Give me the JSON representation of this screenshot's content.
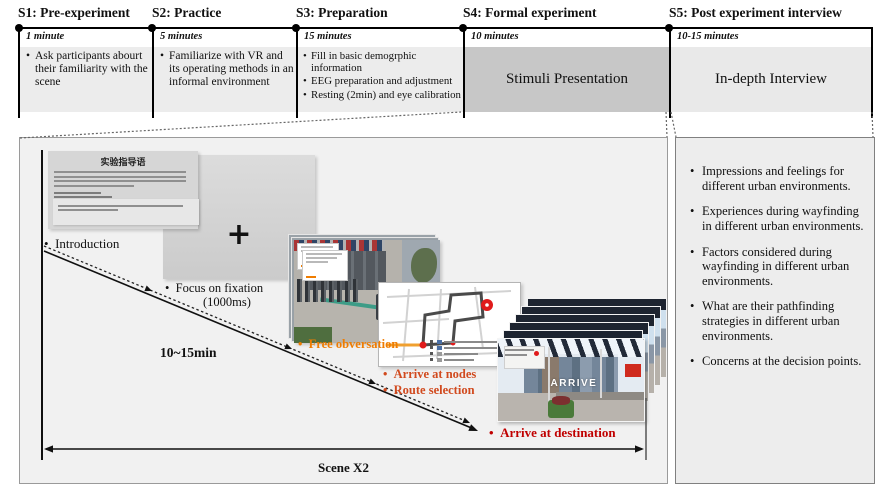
{
  "colors": {
    "s4_box_fill": "#c7c7c7",
    "free_observation_text": "#ef7c00",
    "nodes_route_text": "#d14a1e",
    "destination_text": "#c00000"
  },
  "timeline": {
    "stages": [
      {
        "title": "S1: Pre-experiment",
        "duration": "1 minute",
        "bullets": [
          "Ask participants abourt their familiarity with the scene"
        ]
      },
      {
        "title": "S2: Practice",
        "duration": "5 minutes",
        "bullets": [
          "Familiarize with VR and its operating methods in an informal environment"
        ]
      },
      {
        "title": "S3: Preparation",
        "duration": "15 minutes",
        "bullets": [
          "Fill in basic demogrphic information",
          "EEG preparation and adjustment",
          "Resting (2min) and eye calibration"
        ]
      },
      {
        "title": "S4: Formal experiment",
        "duration": "10 minutes",
        "content": "Stimuli Presentation"
      },
      {
        "title": "S5: Post experiment interview",
        "duration": "10-15 minutes",
        "content": "In-depth Interview"
      }
    ]
  },
  "flow": {
    "instruction_slide_title": "实验指导语",
    "steps": {
      "introduction": "Introduction",
      "fixation_label_line1": "Focus on fixation",
      "fixation_label_line2": "(1000ms)",
      "fixation_cross": "+",
      "free_observation": "Free obversation",
      "arrive_at_nodes": "Arrive at nodes",
      "route_selection": "Route selection",
      "arrive_at_destination": "Arrive at destination"
    },
    "duration_label": "10~15min",
    "scene_label": "Scene X2",
    "arrive_sign": "ARRIVE"
  },
  "interview_panel": {
    "bullets": [
      "Impressions and feelings for different urban environments.",
      "Experiences during wayfinding in different urban environments.",
      "Factors considered during wayfinding in different urban environments.",
      "What are their pathfinding strategies in different urban environments.",
      "Concerns at the decision points."
    ]
  }
}
